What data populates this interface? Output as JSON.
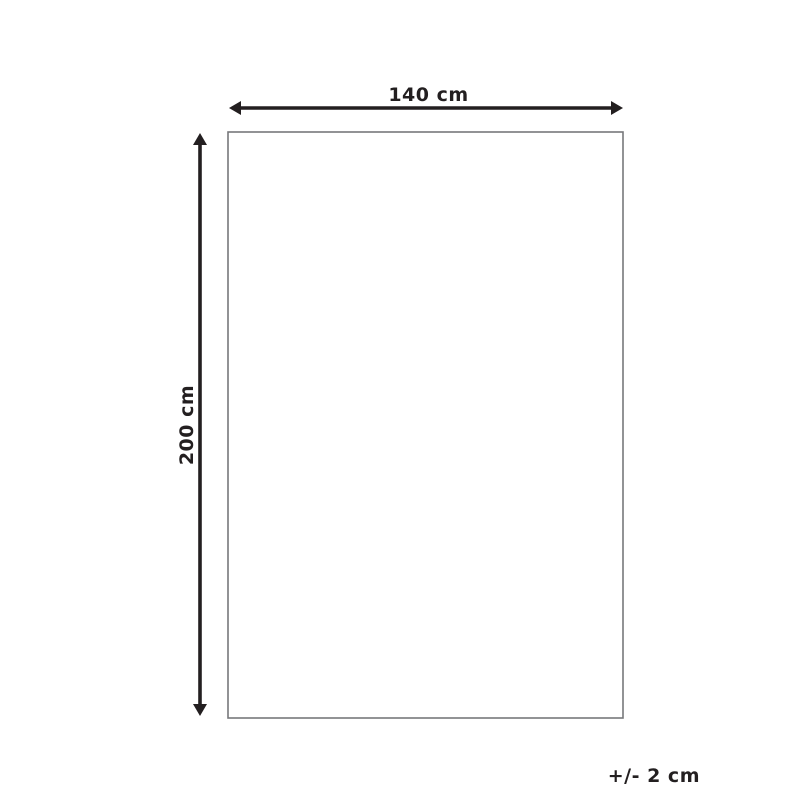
{
  "diagram": {
    "width_label": "140 cm",
    "height_label": "200 cm",
    "tolerance_label": "+/- 2 cm"
  },
  "colors": {
    "arrow": "#231f20",
    "text": "#231f20",
    "rect_border": "#77787b",
    "background": "#ffffff"
  }
}
